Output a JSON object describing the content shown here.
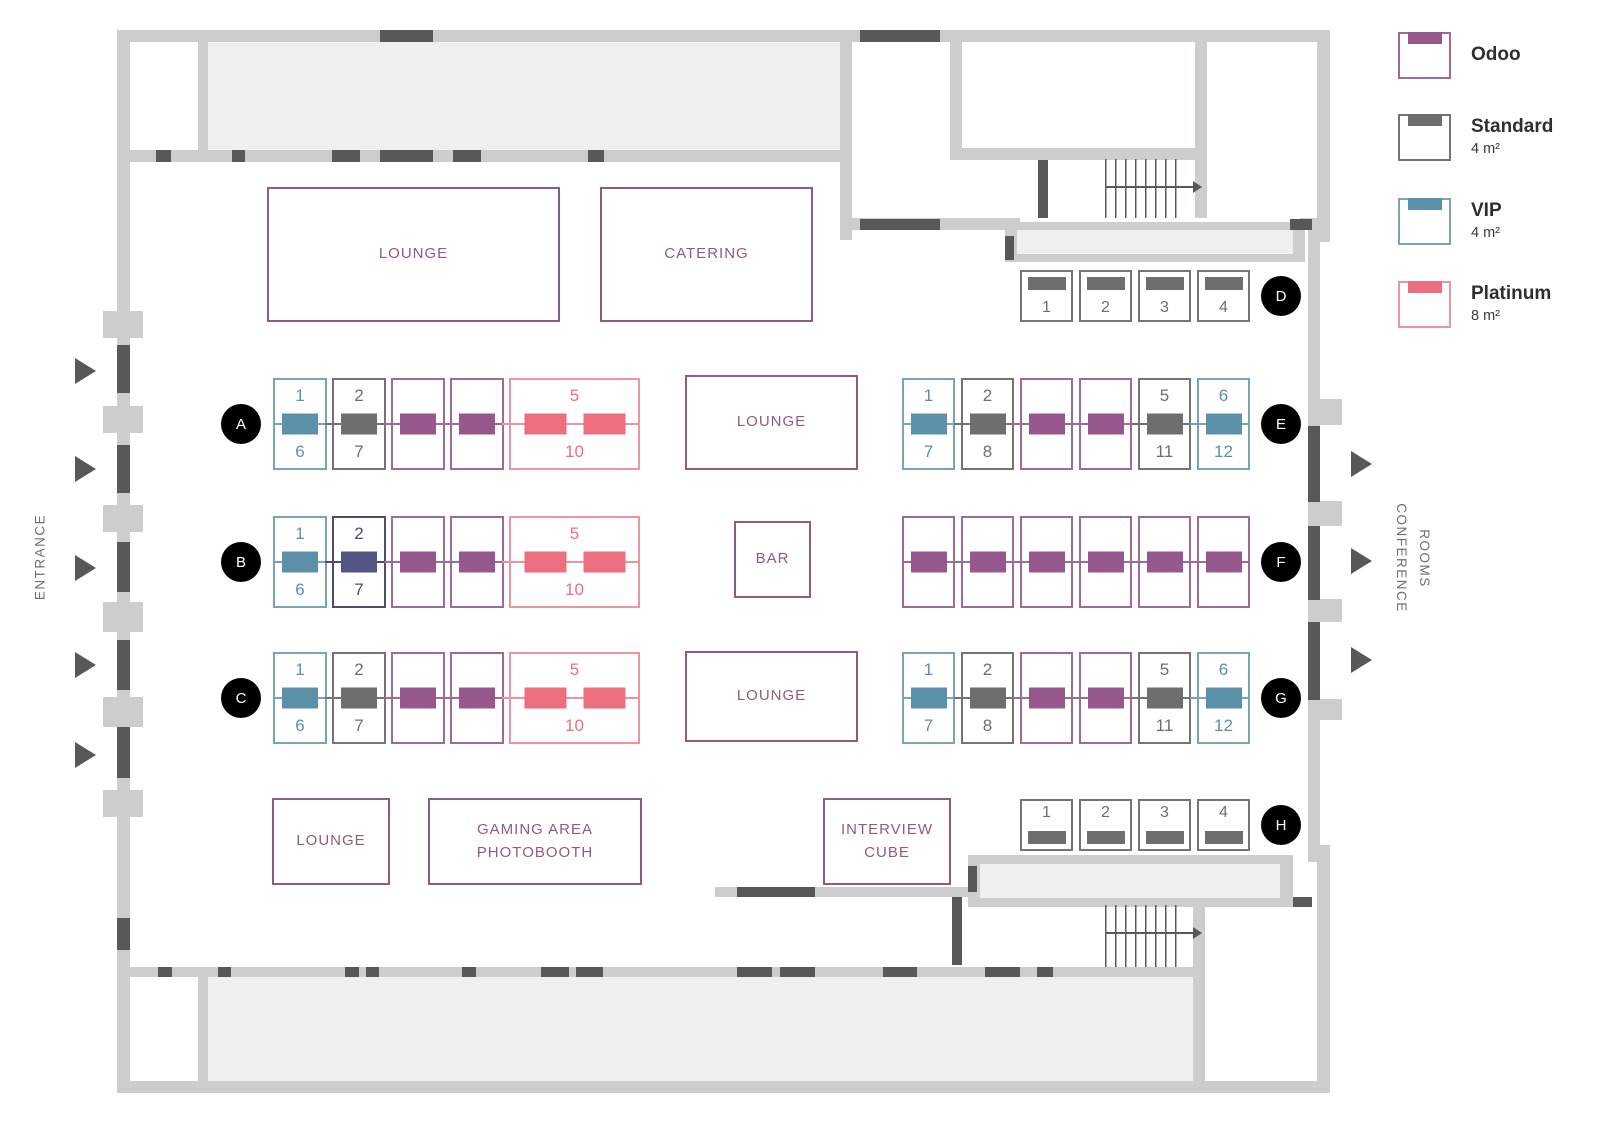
{
  "colors": {
    "odoo_fill": "#96588c",
    "odoo_border": "#9f6a97",
    "standard_fill": "#6e6e6e",
    "standard_border": "#747474",
    "vip_fill": "#5c90a8",
    "vip_border": "#79a4b8",
    "platinum_fill": "#ed6e7f",
    "platinum_border": "#f0939e",
    "indigo_fill": "#555583",
    "indigo_border": "#4d4d73",
    "wall": "#cbcdce",
    "wall_dark": "#58585a",
    "room_fill": "#edeff0",
    "area_accent": "#8e5c7e",
    "marker_bg": "#000000",
    "marker_text": "#ffffff",
    "label_gray": "#6f6f6f"
  },
  "legend": {
    "items": [
      {
        "name": "Odoo",
        "size": ""
      },
      {
        "name": "Standard",
        "size": "4 m²"
      },
      {
        "name": "VIP",
        "size": "4 m²"
      },
      {
        "name": "Platinum",
        "size": "8 m²"
      }
    ]
  },
  "side_labels": {
    "entrance": "ENTRANCE",
    "conference_lines": [
      "CONFERENCE",
      "ROOMS"
    ]
  },
  "areas": {
    "lounge_top": "LOUNGE",
    "catering": "CATERING",
    "lounge_mid": "LOUNGE",
    "bar": "BAR",
    "lounge_low": "LOUNGE",
    "lounge_bottom": "LOUNGE",
    "gaming_lines": [
      "GAMING AREA",
      "PHOTOBOOTH"
    ],
    "interview_lines": [
      "INTERVIEW",
      "CUBE"
    ]
  },
  "rows": [
    {
      "marker": "A",
      "booths": [
        {
          "type": "vip",
          "top": "1",
          "bottom": "6"
        },
        {
          "type": "standard",
          "top": "2",
          "bottom": "7"
        },
        {
          "type": "odoo"
        },
        {
          "type": "odoo"
        },
        {
          "type": "platinum",
          "top": "5",
          "bottom": "10"
        }
      ]
    },
    {
      "marker": "B",
      "booths": [
        {
          "type": "vip",
          "top": "1",
          "bottom": "6"
        },
        {
          "type": "indigo",
          "top": "2",
          "bottom": "7"
        },
        {
          "type": "odoo"
        },
        {
          "type": "odoo"
        },
        {
          "type": "platinum",
          "top": "5",
          "bottom": "10"
        }
      ]
    },
    {
      "marker": "C",
      "booths": [
        {
          "type": "vip",
          "top": "1",
          "bottom": "6"
        },
        {
          "type": "standard",
          "top": "2",
          "bottom": "7"
        },
        {
          "type": "odoo"
        },
        {
          "type": "odoo"
        },
        {
          "type": "platinum",
          "top": "5",
          "bottom": "10"
        }
      ]
    },
    {
      "marker": "D",
      "booths": [
        {
          "type": "standard",
          "label": "1"
        },
        {
          "type": "standard",
          "label": "2"
        },
        {
          "type": "standard",
          "label": "3"
        },
        {
          "type": "standard",
          "label": "4"
        }
      ]
    },
    {
      "marker": "E",
      "booths": [
        {
          "type": "vip",
          "top": "1",
          "bottom": "7"
        },
        {
          "type": "standard",
          "top": "2",
          "bottom": "8"
        },
        {
          "type": "odoo"
        },
        {
          "type": "odoo"
        },
        {
          "type": "standard",
          "top": "5",
          "bottom": "11"
        },
        {
          "type": "vip",
          "top": "6",
          "bottom": "12"
        }
      ]
    },
    {
      "marker": "F",
      "booths": [
        {
          "type": "odoo"
        },
        {
          "type": "odoo"
        },
        {
          "type": "odoo"
        },
        {
          "type": "odoo"
        },
        {
          "type": "odoo"
        },
        {
          "type": "odoo"
        }
      ]
    },
    {
      "marker": "G",
      "booths": [
        {
          "type": "vip",
          "top": "1",
          "bottom": "7"
        },
        {
          "type": "standard",
          "top": "2",
          "bottom": "8"
        },
        {
          "type": "odoo"
        },
        {
          "type": "odoo"
        },
        {
          "type": "standard",
          "top": "5",
          "bottom": "11"
        },
        {
          "type": "vip",
          "top": "6",
          "bottom": "12"
        }
      ]
    },
    {
      "marker": "H",
      "booths": [
        {
          "type": "standard",
          "label": "1"
        },
        {
          "type": "standard",
          "label": "2"
        },
        {
          "type": "standard",
          "label": "3"
        },
        {
          "type": "standard",
          "label": "4"
        }
      ]
    }
  ]
}
